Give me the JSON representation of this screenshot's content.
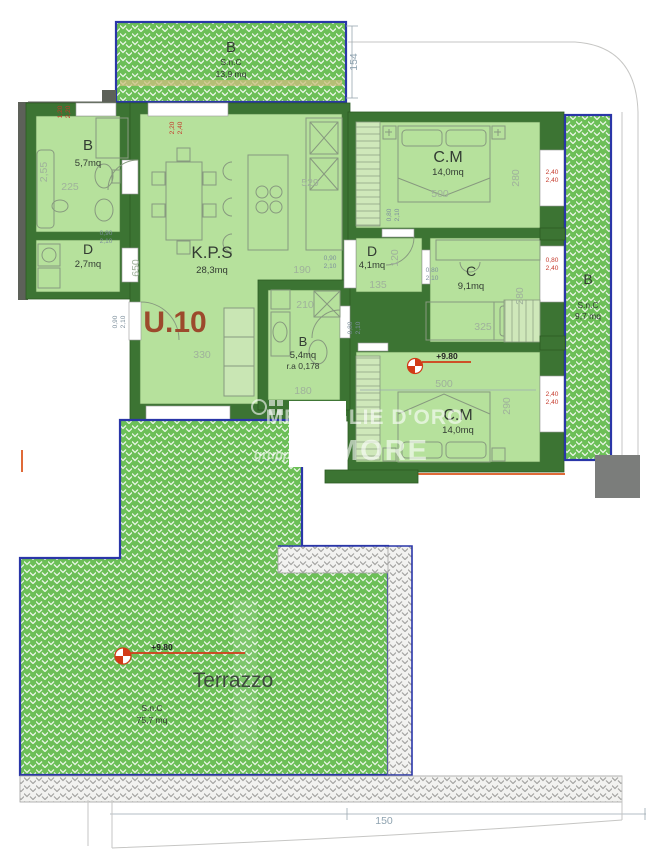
{
  "unit": {
    "label": "U.10",
    "elevation_mark": "+9.80"
  },
  "rooms": {
    "balcony_top": {
      "label": "B",
      "type": "S.n.C",
      "area": "13,9 mq"
    },
    "bath_main": {
      "label": "B",
      "area": "5,7mq"
    },
    "closet": {
      "label": "D",
      "area": "2,7mq"
    },
    "living_kitchen": {
      "label": "K.P.S",
      "area": "28,3mq"
    },
    "bedroom_top": {
      "label": "C.M",
      "area": "14,0mq"
    },
    "hallway": {
      "label": "D",
      "area": "4,1mq"
    },
    "bedroom_single": {
      "label": "C",
      "area": "9,1mq"
    },
    "bath_second": {
      "label": "B",
      "area": "5,4mq",
      "ratio": "r.a 0,178"
    },
    "bedroom_bottom": {
      "label": "C.M",
      "area": "14,0mq"
    },
    "balcony_right": {
      "label": "B",
      "type": "S.n.C",
      "area": "9,7 mq"
    },
    "terrace": {
      "label": "Terrazzo",
      "type": "S.n.C",
      "area": "75,7 mq"
    }
  },
  "dimensions": {
    "balcony_top_depth": "154",
    "living_height": "650",
    "living_width": "529",
    "living_passage": "190",
    "living_wall": "330",
    "bath_main_height": "2,55",
    "bath_main_width": "225",
    "bath_second_top": "210",
    "bath_second_bottom": "180",
    "bedroom_top_width": "500",
    "bedroom_top_height": "280",
    "bedroom_single_width": "325",
    "bedroom_single_height": "280",
    "bedroom_bottom_width": "500",
    "bedroom_bottom_height": "290",
    "hallway_width": "135",
    "hallway_height": "120",
    "site_offset": "150"
  },
  "openings": {
    "win_left_top": {
      "w": "1,20",
      "h": "2,20"
    },
    "win_top": {
      "w": "2,20",
      "h": "2,40"
    },
    "door_closet": {
      "w": "0,90",
      "h": "2,10"
    },
    "door_entry": {
      "w": "0,90",
      "h": "2,10"
    },
    "door_kitchen": {
      "w": "0,90",
      "h": "2,10"
    },
    "door_bedroom_top": {
      "w": "0,80",
      "h": "2,10"
    },
    "door_hallway": {
      "w": "0,80",
      "h": "2,10"
    },
    "door_bath_second": {
      "w": "0,80",
      "h": "2,10"
    },
    "win_right_top": {
      "w": "2,40",
      "h": "2,40"
    },
    "win_right_mid": {
      "w": "0,80",
      "h": "2,40"
    },
    "win_right_bottom": {
      "w": "2,40",
      "h": "2,40"
    }
  },
  "watermark": {
    "brand": "MEDAGLIE D'ORO",
    "group": "gruppo",
    "logo": "MORE"
  },
  "colors": {
    "wall_green": "#3c7433",
    "room_green": "#b6e19c",
    "balcony_hatch_green": "#6cbf57",
    "boundary_blue": "#2a36a8",
    "dim_gray": "#9fb19b",
    "dim_red": "#c5392b",
    "unit_red": "#9c4a2c",
    "section_orange": "#e06a38",
    "pillar_gray": "#7b7d7b"
  }
}
